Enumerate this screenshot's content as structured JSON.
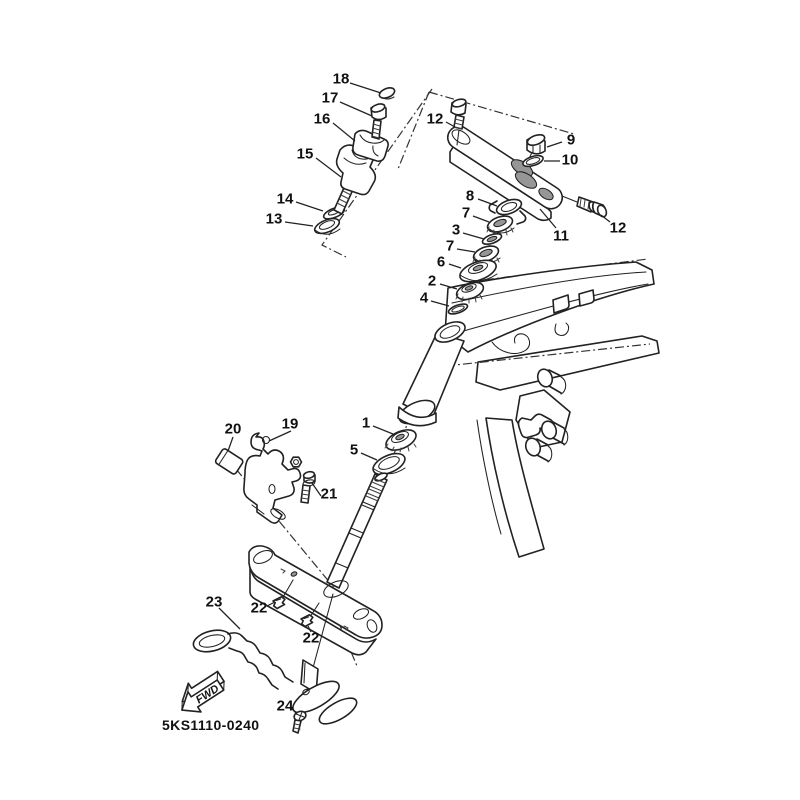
{
  "figure": {
    "drawing_number": "5KS1110-0240",
    "direction_marker": "FWD"
  },
  "callouts": [
    {
      "ref": "18",
      "x": 341,
      "y": 79,
      "leader": [
        350,
        83,
        381,
        93
      ]
    },
    {
      "ref": "17",
      "x": 330,
      "y": 98,
      "leader": [
        340,
        102,
        372,
        116
      ]
    },
    {
      "ref": "16",
      "x": 322,
      "y": 119,
      "leader": [
        333,
        123,
        355,
        141
      ]
    },
    {
      "ref": "15",
      "x": 305,
      "y": 154,
      "leader": [
        316,
        158,
        341,
        177
      ]
    },
    {
      "ref": "14",
      "x": 285,
      "y": 199,
      "leader": [
        296,
        202,
        323,
        211
      ]
    },
    {
      "ref": "13",
      "x": 274,
      "y": 219,
      "leader": [
        285,
        222,
        313,
        226
      ]
    },
    {
      "ref": "12",
      "x": 435,
      "y": 119,
      "leader": [
        446,
        122,
        455,
        127
      ]
    },
    {
      "ref": "9",
      "x": 571,
      "y": 140,
      "leader": [
        562,
        142,
        547,
        147
      ]
    },
    {
      "ref": "10",
      "x": 570,
      "y": 160,
      "leader": [
        560,
        161,
        544,
        161
      ]
    },
    {
      "ref": "11",
      "x": 561,
      "y": 236,
      "leader": [
        556,
        228,
        540,
        209
      ]
    },
    {
      "ref": "12",
      "x": 618,
      "y": 228,
      "leader": [
        610,
        222,
        601,
        215
      ]
    },
    {
      "ref": "8",
      "x": 470,
      "y": 196,
      "leader": [
        478,
        199,
        497,
        206
      ]
    },
    {
      "ref": "7",
      "x": 466,
      "y": 213,
      "leader": [
        473,
        216,
        489,
        222
      ]
    },
    {
      "ref": "3",
      "x": 456,
      "y": 230,
      "leader": [
        463,
        233,
        484,
        239
      ]
    },
    {
      "ref": "7",
      "x": 450,
      "y": 246,
      "leader": [
        457,
        249,
        475,
        252
      ]
    },
    {
      "ref": "6",
      "x": 441,
      "y": 262,
      "leader": [
        449,
        264,
        461,
        268
      ]
    },
    {
      "ref": "2",
      "x": 432,
      "y": 281,
      "leader": [
        440,
        284,
        457,
        289
      ]
    },
    {
      "ref": "4",
      "x": 424,
      "y": 298,
      "leader": [
        431,
        301,
        449,
        306
      ]
    },
    {
      "ref": "1",
      "x": 366,
      "y": 423,
      "leader": [
        373,
        426,
        393,
        434
      ]
    },
    {
      "ref": "5",
      "x": 354,
      "y": 450,
      "leader": [
        361,
        453,
        377,
        460
      ]
    },
    {
      "ref": "19",
      "x": 290,
      "y": 424,
      "leader": [
        291,
        431,
        269,
        441
      ]
    },
    {
      "ref": "20",
      "x": 233,
      "y": 429,
      "leader": [
        233,
        437,
        228,
        451
      ]
    },
    {
      "ref": "21",
      "x": 329,
      "y": 494,
      "leader": [
        321,
        496,
        312,
        483
      ]
    },
    {
      "ref": "22",
      "x": 259,
      "y": 608,
      "leader": [
        267,
        606,
        275,
        602
      ]
    },
    {
      "ref": "22",
      "x": 311,
      "y": 638,
      "leader": [
        311,
        632,
        308,
        626
      ]
    },
    {
      "ref": "23",
      "x": 214,
      "y": 602,
      "leader": [
        219,
        608,
        240,
        629
      ]
    },
    {
      "ref": "24",
      "x": 285,
      "y": 706,
      "leader": [
        291,
        708,
        297,
        714
      ]
    }
  ]
}
